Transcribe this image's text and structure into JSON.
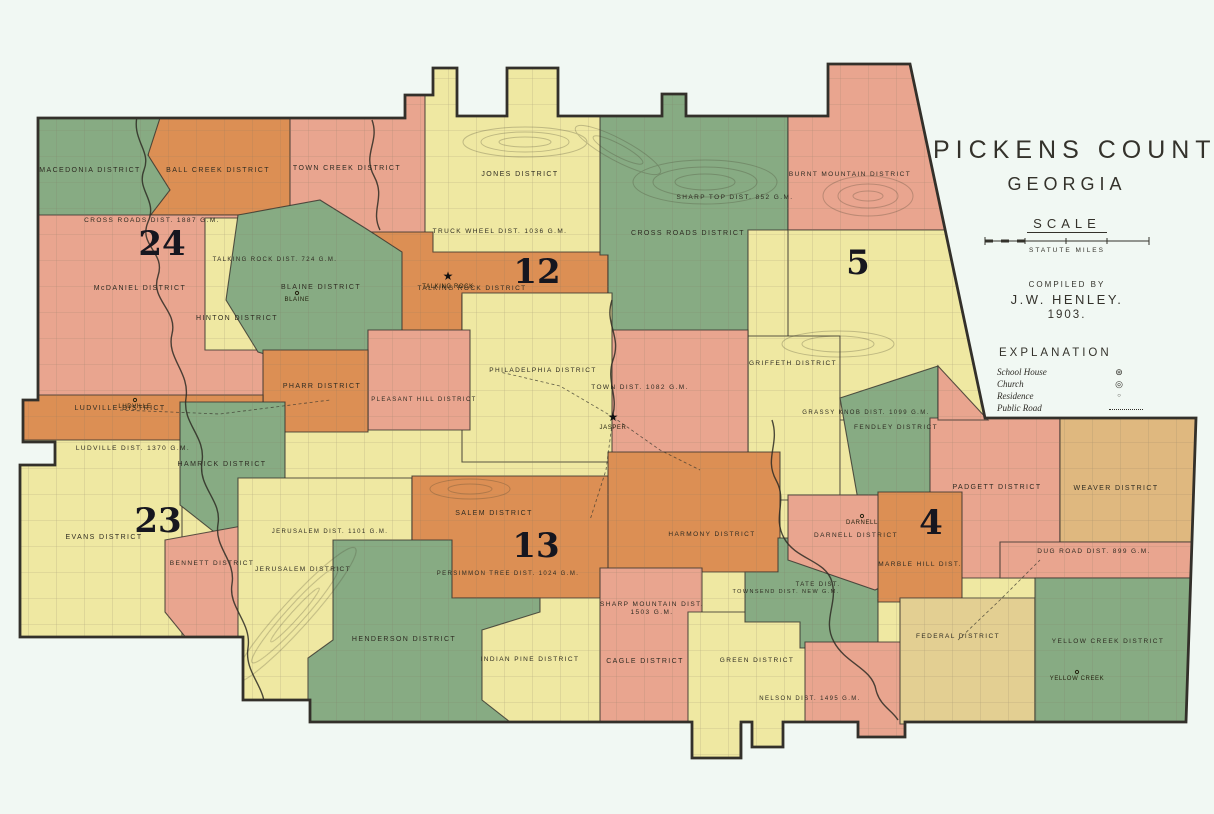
{
  "title_block": {
    "title": "PICKENS COUNTY",
    "subtitle": "GEORGIA",
    "scale_label": "SCALE",
    "scale_units": "STATUTE MILES",
    "compiled_by": "COMPILED BY",
    "compiler": "J.W. HENLEY.",
    "year": "1903.",
    "explanation_title": "EXPLANATION",
    "legend": [
      {
        "label": "School House",
        "type": "school",
        "glyph": "⊛"
      },
      {
        "label": "Church",
        "type": "church",
        "glyph": "◎"
      },
      {
        "label": "Residence",
        "type": "residence",
        "glyph": "○"
      },
      {
        "label": "Public Road",
        "type": "road",
        "glyph": ""
      }
    ]
  },
  "map": {
    "background": "#f1f8f3",
    "outline_color": "#33302a",
    "colors": {
      "green": "#87ab83",
      "orange": "#dc8f54",
      "salmon": "#e9a58f",
      "yellow": "#efe8a2",
      "tan": "#dfb87f",
      "khaki": "#e3cf92"
    },
    "county_outline": "38,118 405,118 405,95 433,95 433,68 457,68 457,116 507,116 507,68 558,68 558,116 662,116 662,94 686,94 686,116 828,116 828,64 910,64 985,418 1196,418 1186,722 905,722 905,737 858,737 858,722 783,722 783,747 752,747 752,722 741,722 741,758 692,758 692,722 310,722 310,700 243,700 243,637 20,637 20,465 55,465 55,442 23,442 23,400 38,400",
    "regions": [
      {
        "id": "town-creek",
        "color": "salmon",
        "points": "283,55 433,55 433,262 380,262 330,215 283,215"
      },
      {
        "id": "ball-creek",
        "color": "orange",
        "points": "145,55 290,55 290,215 150,215"
      },
      {
        "id": "macedonia",
        "color": "green",
        "points": "30,55 150,55 160,118 148,155 170,190 150,216 30,216"
      },
      {
        "id": "mcdaniel-crossroads",
        "color": "salmon",
        "points": "30,215 268,215 268,398 30,398"
      },
      {
        "id": "hinton",
        "color": "yellow",
        "points": "205,218 272,218 272,350 205,350"
      },
      {
        "id": "jones-truckwheel",
        "color": "yellow",
        "points": "425,55 608,55 608,255 425,255"
      },
      {
        "id": "talking-rock",
        "color": "orange",
        "points": "340,232 433,232 433,252 608,252 608,295 462,295 462,334 368,334 368,350 263,350 263,300 340,300"
      },
      {
        "id": "blaine",
        "color": "green",
        "points": "238,215 320,200 365,228 402,252 402,338 340,376 258,352 226,300"
      },
      {
        "id": "sharp-top-crossroads",
        "color": "green",
        "points": "600,55 788,55 788,230 748,230 748,336 608,336 608,255 600,255"
      },
      {
        "id": "burnt-mountain",
        "color": "salmon",
        "points": "788,55 915,55 952,230 788,230"
      },
      {
        "id": "five-district",
        "color": "yellow",
        "points": "788,230 952,230 986,420 788,420"
      },
      {
        "id": "griffeth-grassyknob",
        "color": "yellow",
        "points": "748,336 840,336 840,500 748,500"
      },
      {
        "id": "fendley",
        "color": "green",
        "points": "840,398 938,366 938,500 858,500"
      },
      {
        "id": "town-jasper",
        "color": "salmon",
        "points": "608,330 748,330 748,458 608,458"
      },
      {
        "id": "philadelphia",
        "color": "yellow",
        "points": "462,293 612,293 612,462 462,462"
      },
      {
        "id": "pleasant-hill",
        "color": "salmon",
        "points": "368,330 470,330 470,430 368,430"
      },
      {
        "id": "pharr",
        "color": "orange",
        "points": "263,350 368,350 368,432 263,432"
      },
      {
        "id": "ludville",
        "color": "orange",
        "points": "23,395 263,395 263,467 23,467"
      },
      {
        "id": "evans",
        "color": "yellow",
        "points": "16,440 182,440 182,640 16,640"
      },
      {
        "id": "hamrick",
        "color": "green",
        "points": "180,402 285,402 285,520 232,546 180,505"
      },
      {
        "id": "bennett",
        "color": "salmon",
        "points": "165,540 253,524 253,650 196,650 165,612"
      },
      {
        "id": "jerusalem",
        "color": "yellow",
        "points": "238,478 412,478 412,542 345,542 345,706 238,706"
      },
      {
        "id": "salem-persimmon",
        "color": "orange",
        "points": "412,476 620,476 620,600 412,600"
      },
      {
        "id": "indian-pine",
        "color": "yellow",
        "points": "455,598 692,598 692,722 455,722"
      },
      {
        "id": "henderson",
        "color": "green",
        "points": "333,540 452,540 452,598 540,598 540,612 482,630 482,700 510,722 308,722 308,658 333,640"
      },
      {
        "id": "harmony",
        "color": "orange",
        "points": "608,452 780,452 780,572 608,572"
      },
      {
        "id": "sharpmtn-cagle",
        "color": "salmon",
        "points": "600,568 702,568 702,620 692,620 692,722 600,722"
      },
      {
        "id": "green-district",
        "color": "yellow",
        "points": "688,612 815,612 815,724 783,724 783,748 752,748 752,724 740,724 740,760 692,760 692,724 688,724"
      },
      {
        "id": "tate-townsend",
        "color": "green",
        "points": "778,538 878,538 878,648 800,648 800,622 745,622 745,572 778,572"
      },
      {
        "id": "darnell",
        "color": "salmon",
        "points": "788,495 938,495 938,560 875,590 788,560"
      },
      {
        "id": "nelson",
        "color": "salmon",
        "points": "805,642 908,642 908,738 858,738 858,724 805,724"
      },
      {
        "id": "padgett",
        "color": "salmon",
        "points": "930,418 1060,418 1060,578 930,578"
      },
      {
        "id": "weaver",
        "color": "tan",
        "points": "1060,418 1198,418 1198,542 1060,542"
      },
      {
        "id": "dug-road",
        "color": "salmon",
        "points": "1000,542 1198,542 1198,578 1000,578"
      },
      {
        "id": "marble-hill",
        "color": "orange",
        "points": "878,492 962,492 962,602 878,602"
      },
      {
        "id": "federal",
        "color": "khaki",
        "points": "900,598 1035,598 1035,724 900,724"
      },
      {
        "id": "yellow-creek",
        "color": "green",
        "points": "1035,578 1192,578 1192,724 1035,724"
      },
      {
        "id": "fendley-east-strip",
        "color": "salmon",
        "points": "938,366 988,420 938,420"
      }
    ],
    "districts": [
      {
        "name": "MACEDONIA DISTRICT",
        "x": 90,
        "y": 172
      },
      {
        "name": "BALL CREEK DISTRICT",
        "x": 218,
        "y": 172
      },
      {
        "name": "TOWN CREEK DISTRICT",
        "x": 347,
        "y": 170
      },
      {
        "name": "JONES DISTRICT",
        "x": 520,
        "y": 176
      },
      {
        "name": "TRUCK WHEEL DIST. 1036 G.M.",
        "x": 500,
        "y": 233,
        "fs": 6.5
      },
      {
        "name": "BURNT MOUNTAIN DISTRICT",
        "x": 850,
        "y": 176,
        "fs": 6.5
      },
      {
        "name": "SHARP TOP DIST. 852 G.M.",
        "x": 735,
        "y": 199,
        "fs": 6.5
      },
      {
        "name": "CROSS ROADS DISTRICT",
        "x": 688,
        "y": 235
      },
      {
        "name": "CROSS ROADS DIST. 1887 G.M.",
        "x": 152,
        "y": 222,
        "fs": 6.5
      },
      {
        "name": "McDANIEL DISTRICT",
        "x": 140,
        "y": 290
      },
      {
        "name": "HINTON DISTRICT",
        "x": 237,
        "y": 320
      },
      {
        "name": "TALKING ROCK DIST. 724 G.M.",
        "x": 275,
        "y": 261,
        "fs": 6
      },
      {
        "name": "BLAINE DISTRICT",
        "x": 321,
        "y": 289
      },
      {
        "name": "TALKING ROCK DISTRICT",
        "x": 472,
        "y": 290,
        "fs": 6.5
      },
      {
        "name": "PHILADELPHIA DISTRICT",
        "x": 543,
        "y": 372,
        "fs": 6.5
      },
      {
        "name": "TOWN DIST. 1082 G.M.",
        "x": 640,
        "y": 389,
        "fs": 6.5
      },
      {
        "name": "PHARR DISTRICT",
        "x": 322,
        "y": 388
      },
      {
        "name": "PLEASANT HILL DISTRICT",
        "x": 424,
        "y": 401,
        "fs": 6
      },
      {
        "name": "LUDVILLE DISTRICT",
        "x": 120,
        "y": 410
      },
      {
        "name": "LUDVILLE DIST. 1370 G.M.",
        "x": 133,
        "y": 450,
        "fs": 6.5
      },
      {
        "name": "HAMRICK DISTRICT",
        "x": 222,
        "y": 466
      },
      {
        "name": "GRIFFETH DISTRICT",
        "x": 793,
        "y": 365,
        "fs": 6.5
      },
      {
        "name": "GRASSY KNOB DIST. 1099 G.M.",
        "x": 866,
        "y": 414,
        "fs": 6
      },
      {
        "name": "FENDLEY DISTRICT",
        "x": 896,
        "y": 429,
        "fs": 6.5
      },
      {
        "name": "EVANS DISTRICT",
        "x": 104,
        "y": 539
      },
      {
        "name": "BENNETT DISTRICT",
        "x": 212,
        "y": 565,
        "fs": 6.5
      },
      {
        "name": "JERUSALEM DIST. 1101 G.M.",
        "x": 330,
        "y": 533,
        "fs": 6
      },
      {
        "name": "JERUSALEM DISTRICT",
        "x": 303,
        "y": 571,
        "fs": 6.5
      },
      {
        "name": "SALEM DISTRICT",
        "x": 494,
        "y": 515
      },
      {
        "name": "PERSIMMON TREE DIST. 1024 G.M.",
        "x": 508,
        "y": 575,
        "fs": 6
      },
      {
        "name": "HENDERSON DISTRICT",
        "x": 404,
        "y": 641
      },
      {
        "name": "INDIAN PINE DISTRICT",
        "x": 530,
        "y": 661,
        "fs": 6.5
      },
      {
        "name": "HARMONY DISTRICT",
        "x": 712,
        "y": 536,
        "fs": 6.5
      },
      {
        "name": "SHARP MOUNTAIN DIST.",
        "x": 652,
        "y": 606,
        "line2": "1503 G.M.",
        "fs": 6.5
      },
      {
        "name": "CAGLE DISTRICT",
        "x": 645,
        "y": 663
      },
      {
        "name": "GREEN DISTRICT",
        "x": 757,
        "y": 662,
        "fs": 6.5
      },
      {
        "name": "TOWNSEND DIST. NEW G.M.",
        "x": 786,
        "y": 593,
        "fs": 5.5
      },
      {
        "name": "TATE DIST.",
        "x": 818,
        "y": 586,
        "fs": 6
      },
      {
        "name": "NELSON DIST. 1495 G.M.",
        "x": 810,
        "y": 700,
        "fs": 6
      },
      {
        "name": "DARNELL DISTRICT",
        "x": 856,
        "y": 537,
        "fs": 6.5
      },
      {
        "name": "MARBLE HILL DIST.",
        "x": 920,
        "y": 566,
        "fs": 6.5
      },
      {
        "name": "PADGETT DISTRICT",
        "x": 997,
        "y": 489
      },
      {
        "name": "WEAVER DISTRICT",
        "x": 1116,
        "y": 490
      },
      {
        "name": "DUG ROAD DIST. 899 G.M.",
        "x": 1094,
        "y": 553,
        "fs": 6.5
      },
      {
        "name": "FEDERAL DISTRICT",
        "x": 958,
        "y": 638,
        "fs": 6.5
      },
      {
        "name": "YELLOW CREEK DISTRICT",
        "x": 1108,
        "y": 643,
        "fs": 6.5
      }
    ],
    "land_district_numbers": [
      {
        "value": "24",
        "x": 162,
        "y": 255
      },
      {
        "value": "12",
        "x": 537,
        "y": 283
      },
      {
        "value": "5",
        "x": 858,
        "y": 274
      },
      {
        "value": "23",
        "x": 158,
        "y": 532
      },
      {
        "value": "13",
        "x": 536,
        "y": 557
      },
      {
        "value": "4",
        "x": 931,
        "y": 534
      }
    ],
    "places": [
      {
        "name": "JASPER",
        "x": 613,
        "y": 417,
        "star": true
      },
      {
        "name": "TALKING ROCK",
        "x": 448,
        "y": 276,
        "star": true
      },
      {
        "name": "LUDVILLE",
        "x": 135,
        "y": 404,
        "star": false
      },
      {
        "name": "BLAINE",
        "x": 297,
        "y": 297,
        "star": false
      },
      {
        "name": "DARNELL",
        "x": 862,
        "y": 520,
        "star": false
      },
      {
        "name": "YELLOW CREEK",
        "x": 1077,
        "y": 676,
        "star": false
      }
    ]
  }
}
